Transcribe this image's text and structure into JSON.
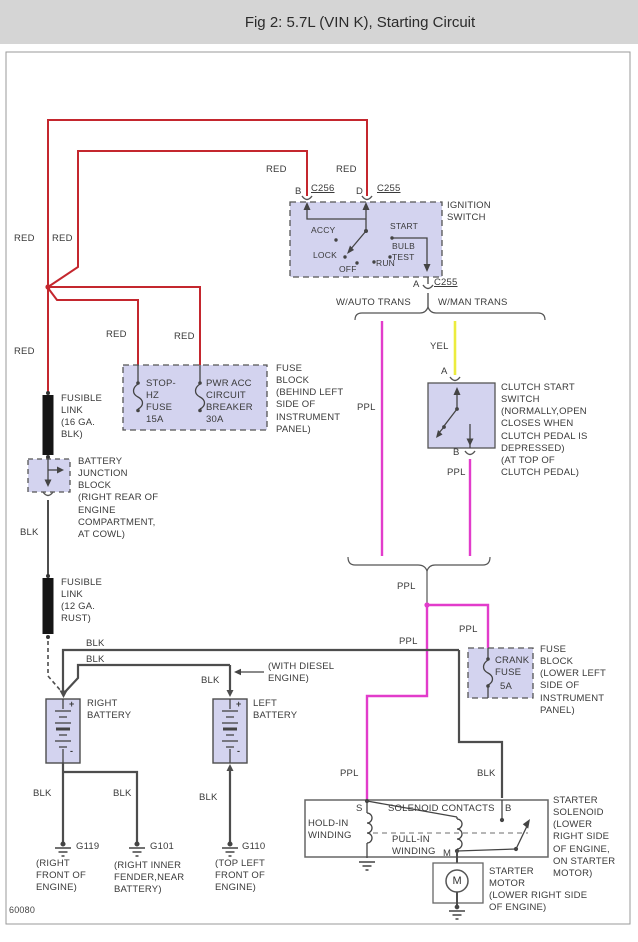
{
  "title": "Fig 2: 5.7L (VIN K), Starting Circuit",
  "figure_number": "60080",
  "wires": {
    "red": "RED",
    "blk": "BLK",
    "ppl": "PPL",
    "yel": "YEL"
  },
  "colors": {
    "red": "#c4272e",
    "purple": "#e23ccb",
    "yellow": "#ecec3e",
    "wire_gray": "#4d4d4d",
    "block_fill": "#d3d3ef"
  },
  "ignition": {
    "label": "IGNITION\nSWITCH",
    "conn_b": "B",
    "conn_b_id": "C256",
    "conn_d": "D",
    "conn_d_id": "C255",
    "conn_a": "A",
    "conn_a_id": "C255",
    "accy": "ACCY",
    "lock": "LOCK",
    "off": "OFF",
    "run": "RUN",
    "bulb_test": "BULB\nTEST",
    "start": "START"
  },
  "branch": {
    "auto": "W/AUTO TRANS",
    "man": "W/MAN TRANS"
  },
  "fuse_block_ip": {
    "fuse": "STOP-\nHZ\nFUSE\n15A",
    "breaker": "PWR ACC\nCIRCUIT\nBREAKER\n30A",
    "label": "FUSE\nBLOCK\n(BEHIND LEFT\nSIDE OF\nINSTRUMENT\nPANEL)"
  },
  "fusible_link_16": "FUSIBLE\nLINK\n(16 GA.\nBLK)",
  "fusible_link_12": "FUSIBLE\nLINK\n(12 GA.\nRUST)",
  "battery_junction": "BATTERY\nJUNCTION\nBLOCK\n(RIGHT REAR OF\nENGINE\nCOMPARTMENT,\nAT COWL)",
  "clutch": {
    "label": "CLUTCH START\nSWITCH\n(NORMALLY,OPEN\nCLOSES WHEN\nCLUTCH PEDAL IS\nDEPRESSED)\n(AT TOP OF\nCLUTCH PEDAL)",
    "conn_a": "A",
    "conn_b": "B"
  },
  "crank_fuse": {
    "name": "CRANK\nFUSE",
    "amps": "5A",
    "label": "FUSE\nBLOCK\n(LOWER LEFT\nSIDE OF\nINSTRUMENT\nPANEL)"
  },
  "battery": {
    "right": "RIGHT\nBATTERY",
    "left": "LEFT\nBATTERY",
    "diesel": "(WITH DIESEL\nENGINE)",
    "plus": "+",
    "minus": "-"
  },
  "grounds": {
    "g119": {
      "id": "G119",
      "loc": "(RIGHT\nFRONT OF\nENGINE)"
    },
    "g101": {
      "id": "G101",
      "loc": "(RIGHT INNER\nFENDER,NEAR\nBATTERY)"
    },
    "g110": {
      "id": "G110",
      "loc": "(TOP LEFT\nFRONT OF\nENGINE)"
    }
  },
  "solenoid": {
    "label": "STARTER\nSOLENOID\n(LOWER\nRIGHT SIDE\nOF ENGINE,\nON STARTER\nMOTOR)",
    "contacts": "SOLENOID CONTACTS",
    "hold_in": "HOLD-IN\nWINDING",
    "pull_in": "PULL-IN\nWINDING",
    "term_s": "S",
    "term_b": "B",
    "term_m": "M"
  },
  "motor": {
    "label": "STARTER\nMOTOR\n(LOWER RIGHT SIDE\nOF ENGINE)",
    "symbol": "M"
  }
}
